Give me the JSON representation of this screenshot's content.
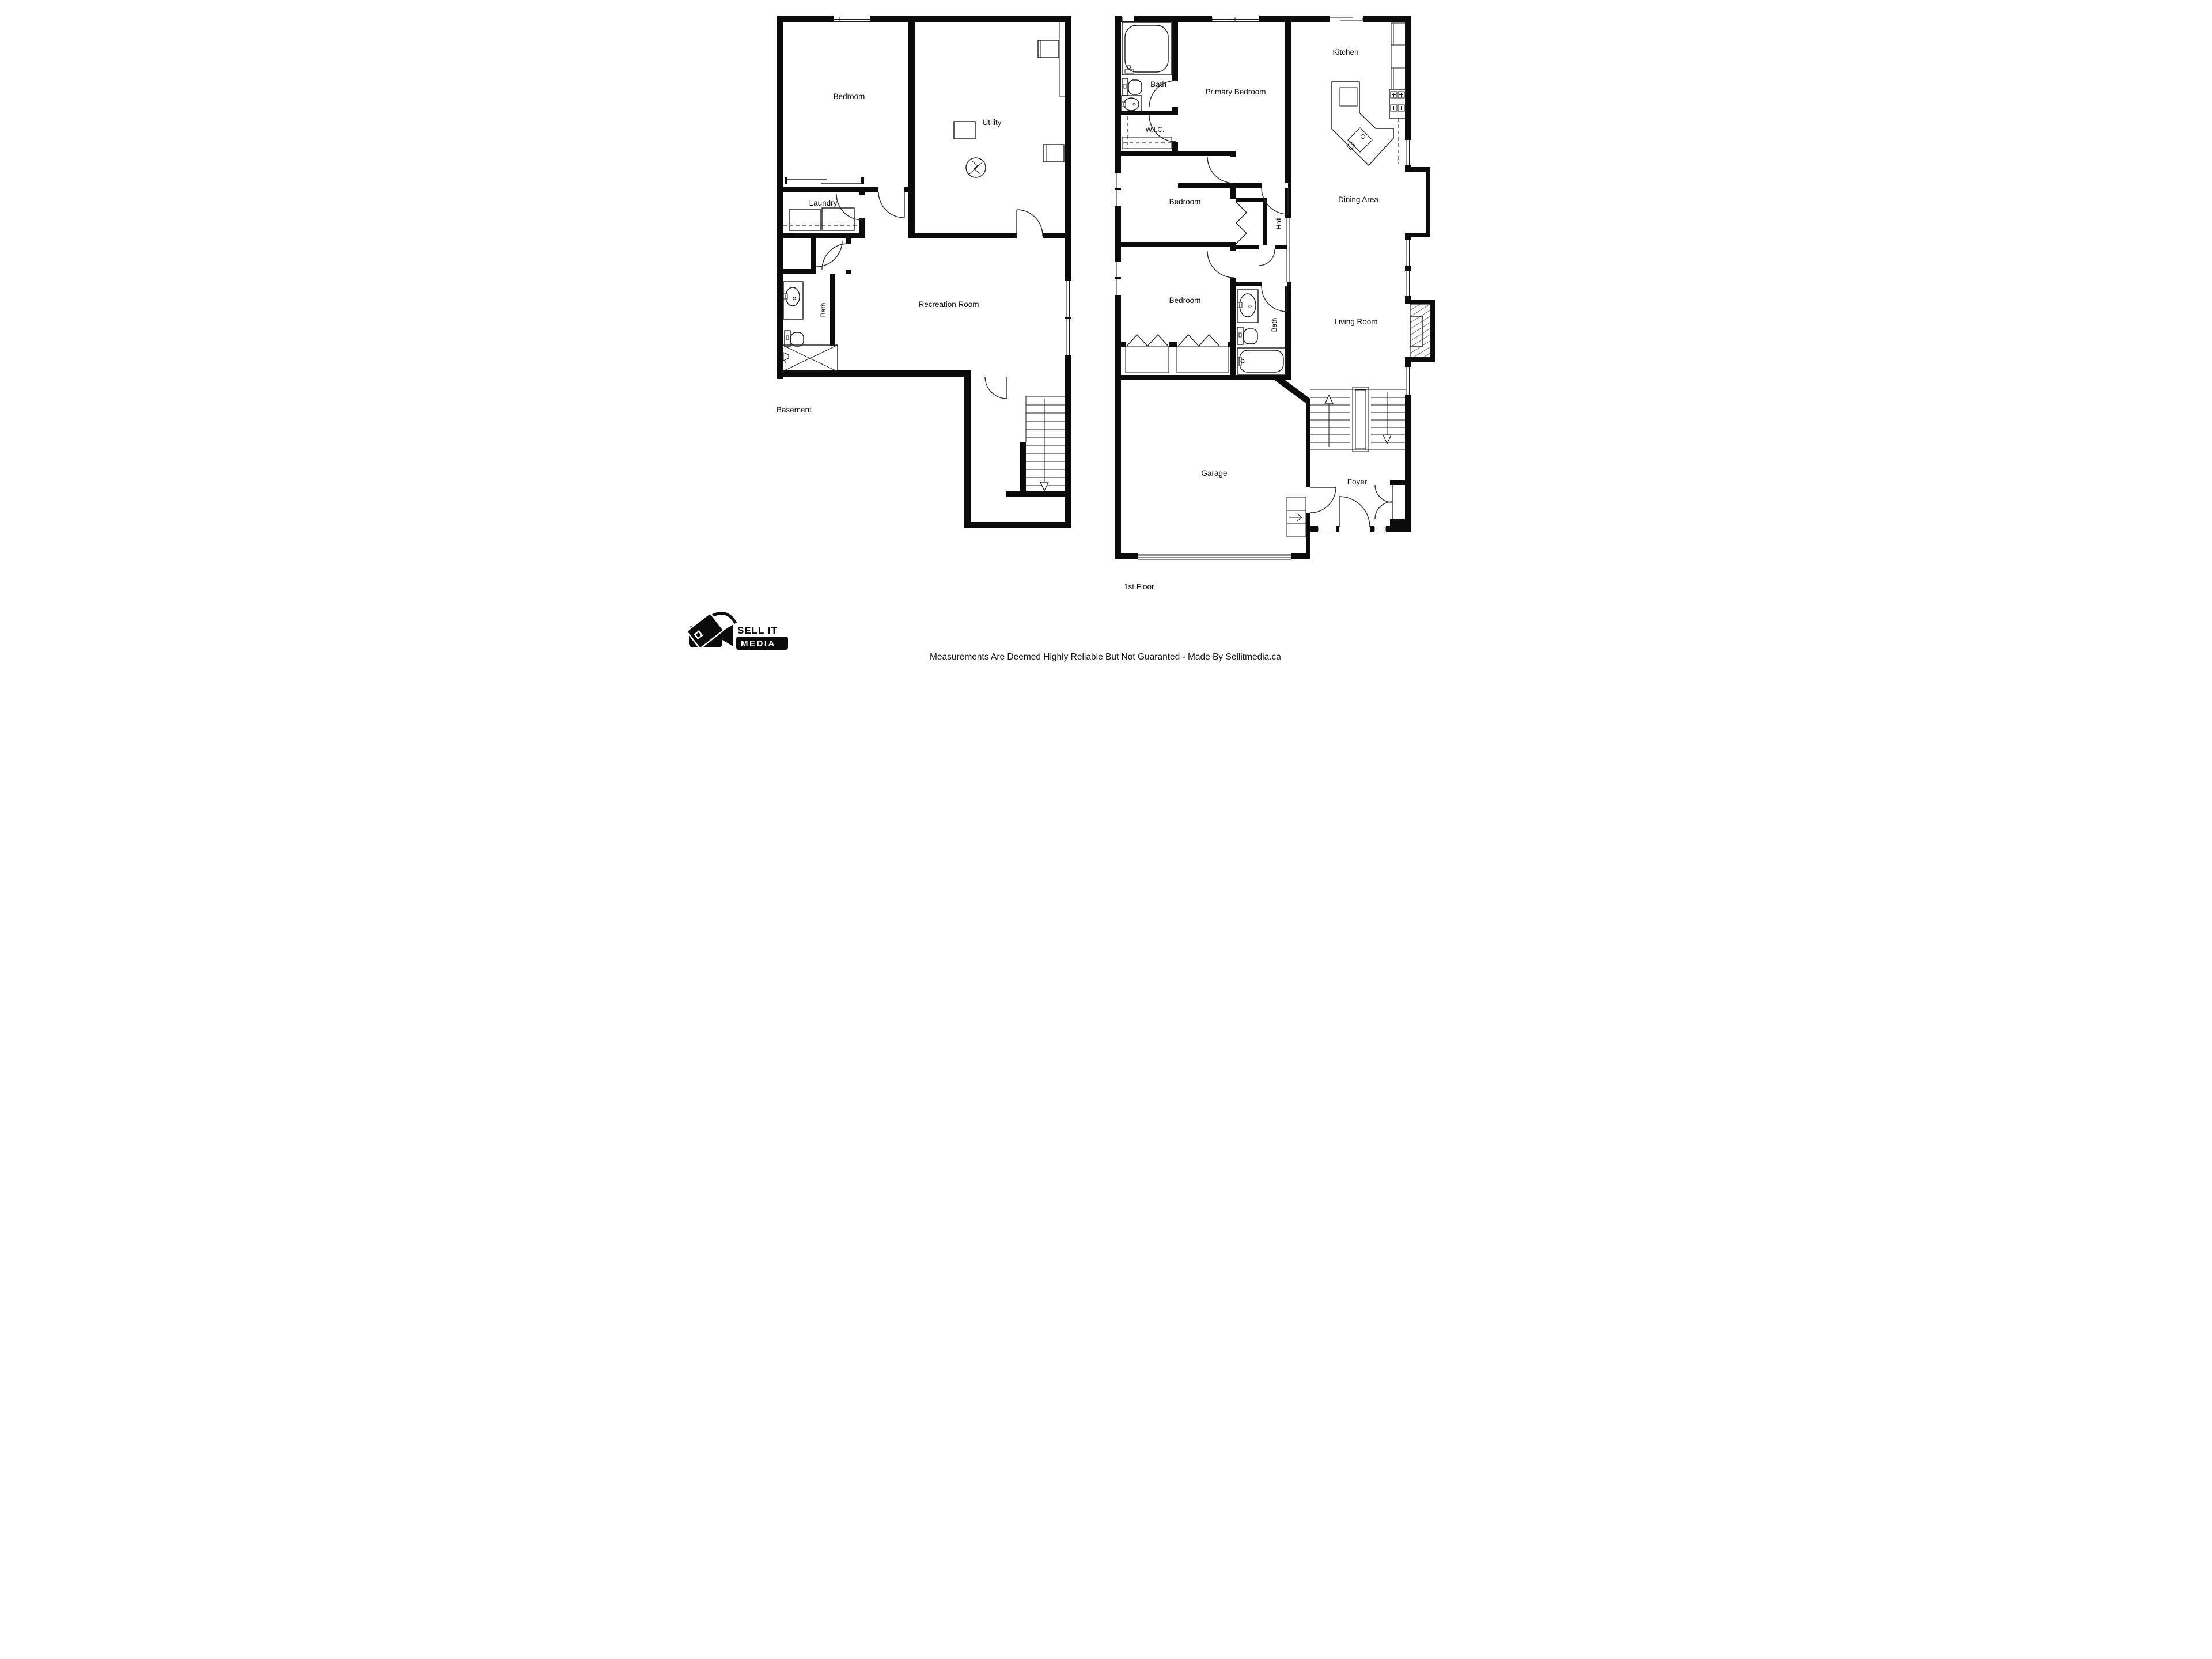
{
  "page": {
    "background": "#ffffff",
    "ink": "#0b0b0b"
  },
  "plans": {
    "basement": {
      "title": "Basement",
      "rooms": {
        "bedroom": "Bedroom",
        "utility": "Utility",
        "laundry": "Laundry",
        "bath": "Bath",
        "recreation": "Recreation Room"
      }
    },
    "first_floor": {
      "title": "1st Floor",
      "rooms": {
        "bath_upper": "Bath",
        "primary_bedroom": "Primary Bedroom",
        "wic": "W.I.C.",
        "kitchen": "Kitchen",
        "bedroom_mid": "Bedroom",
        "hall": "Hall",
        "dining": "Dining Area",
        "bedroom_lower": "Bedroom",
        "bath_lower": "Bath",
        "living": "Living Room",
        "garage": "Garage",
        "foyer": "Foyer"
      }
    }
  },
  "branding": {
    "logo_line1": "SELL IT",
    "logo_line2": "MEDIA"
  },
  "footer": {
    "disclaimer": "Measurements Are Deemed Highly Reliable But Not Guaranted - Made By Sellitmedia.ca"
  },
  "icons": [
    "bathtub-icon",
    "toilet-icon",
    "sink-icon",
    "shower-icon",
    "washer-dryer-icon",
    "water-heater-icon",
    "furnace-icon",
    "sump-pump-icon",
    "stove-icon",
    "kitchen-island-sink-icon",
    "fireplace-icon",
    "stairs-up-arrow-icon",
    "stairs-down-arrow-icon",
    "garage-door-icon",
    "window-icon",
    "door-arc-icon",
    "closet-bifold-icon",
    "video-camera-tag-icon"
  ]
}
